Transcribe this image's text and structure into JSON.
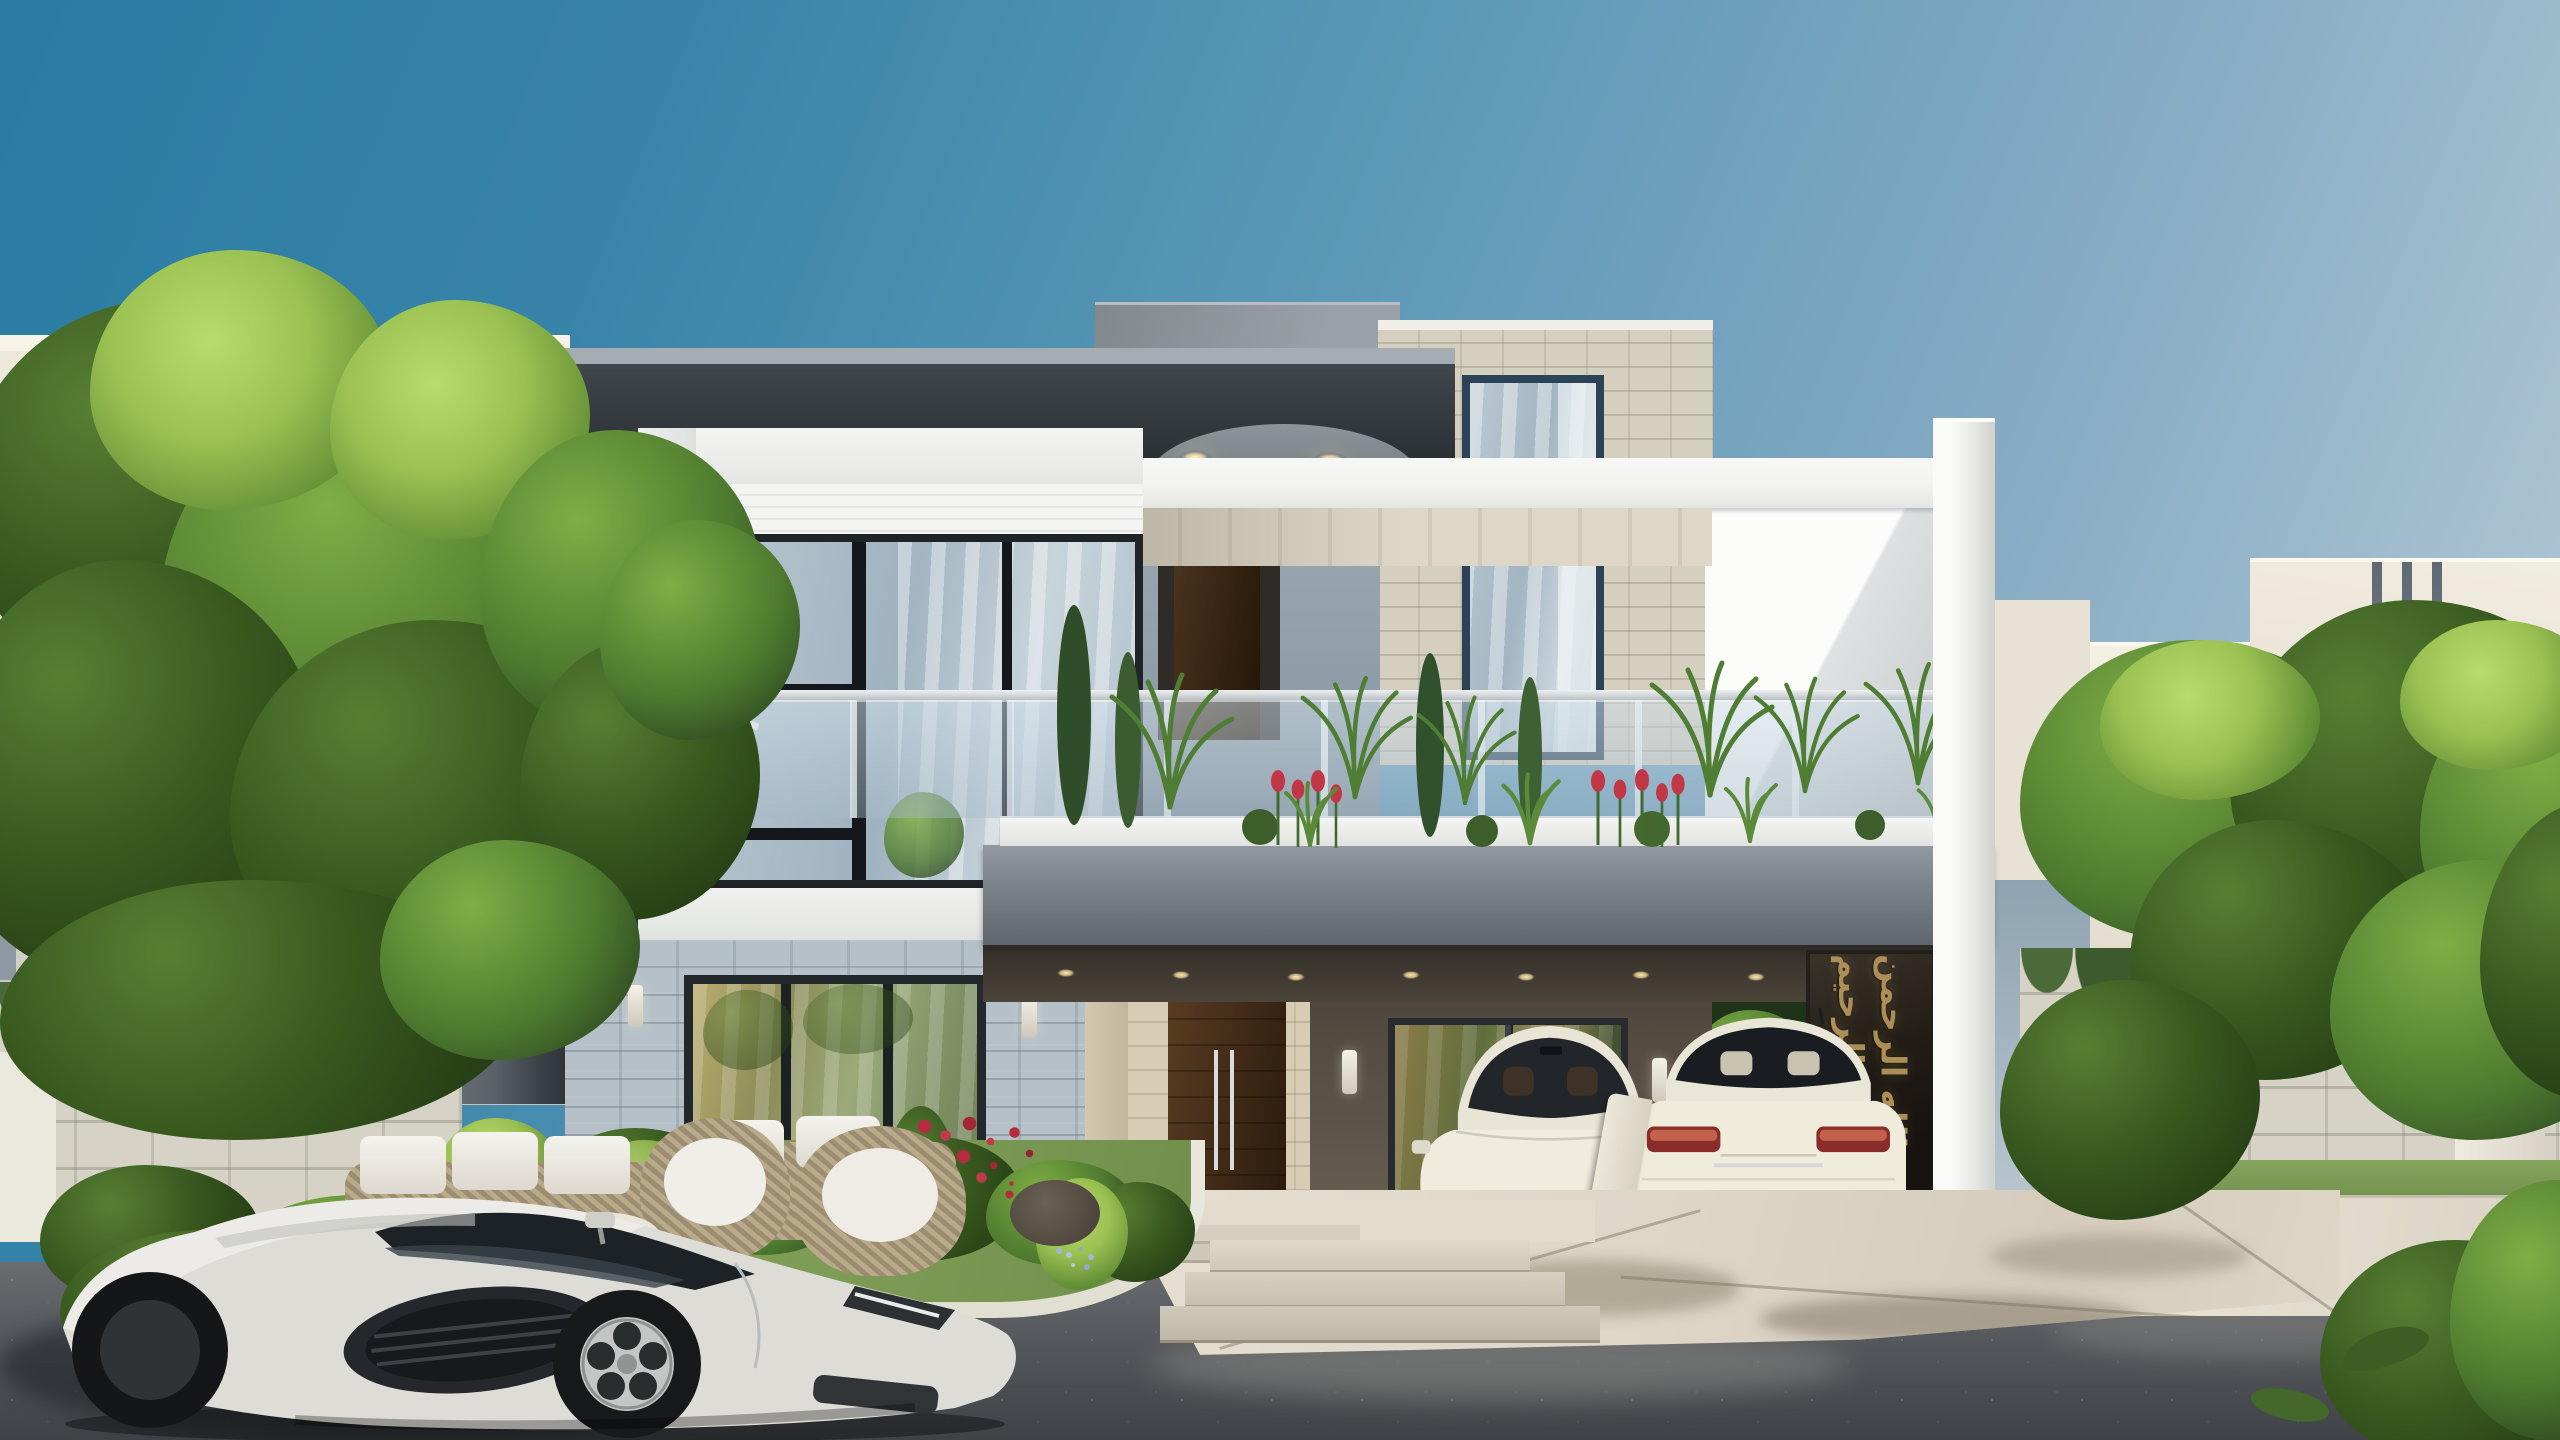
{
  "scene_type": "architectural-exterior-render",
  "calligraphy": {
    "text": "الله الرحمن الرحيم"
  },
  "palette": {
    "sky_top": "#2a7ba2",
    "sky_mid": "#5f9ab8",
    "sky_low": "#a9c2d1",
    "frame_dark": "#2c3136",
    "frame_light": "#6f767b",
    "slab_white": "#f3f4f2",
    "soffit_beige": "#d9d1c0",
    "brick_gray": "#b5c0c8",
    "brick_beige": "#d5cfc0",
    "carport_wall": "#5e554a",
    "carport_ceiling": "#332e28",
    "glass_blue": "#a9bcc8",
    "glass_gold": "#857a48",
    "foliage_dark": "#263f15",
    "foliage_mid": "#4e7a2f",
    "foliage_light": "#9cc253",
    "grass": "#7d9b55",
    "rose_red": "#b52c3e",
    "tulip_red": "#c13746",
    "driveway": "#ddd5c6",
    "road": "#54575b",
    "stone_wall": "#d6d3c6",
    "door_wood": "#4a2f18",
    "gold": "#b3945a",
    "car_white": "#e9e6da"
  }
}
